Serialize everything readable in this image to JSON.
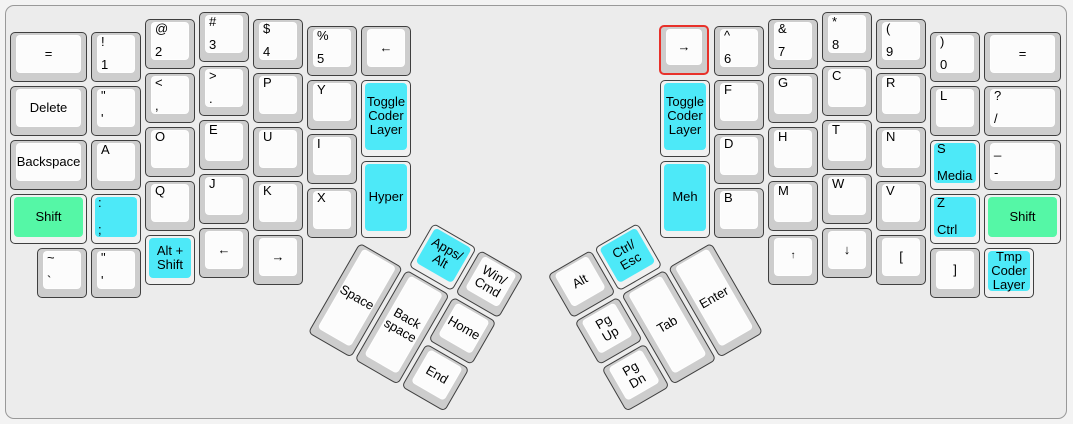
{
  "app": {
    "description": "ergodox-keyboard-layout"
  },
  "colors": {
    "page_background": "#f3f3f3",
    "board_background": "#ececec",
    "board_border": "#999999",
    "key_side": "#cdcdcd",
    "key_face": "#fcfcfc",
    "colored_key_side": "#f1f1f1",
    "cyan": "#4de9f8",
    "green": "#55f7a6",
    "selected_outline": "#e8312a",
    "legend": "#000000"
  },
  "layout": {
    "unit_px": 54,
    "key_inset_px": 2,
    "groups": [
      {
        "name": "left-main-cluster",
        "origin_x": 8,
        "origin_y": 10,
        "rotation_deg": 0,
        "keys": [
          {
            "name": "equal-left",
            "x": 0,
            "y": 0.375,
            "w": 1.5,
            "center": "="
          },
          {
            "name": "delete",
            "x": 0,
            "y": 1.375,
            "w": 1.5,
            "center": "Delete"
          },
          {
            "name": "backspace",
            "x": 0,
            "y": 2.375,
            "w": 1.5,
            "center": "Backspace"
          },
          {
            "name": "shift-left",
            "x": 0,
            "y": 3.375,
            "w": 1.5,
            "center": "Shift",
            "color": "green"
          },
          {
            "name": "exclamation-1",
            "x": 1.5,
            "y": 0.375,
            "top": "!",
            "bottom": "1"
          },
          {
            "name": "quote-apostrophe",
            "x": 1.5,
            "y": 1.375,
            "top": "\"",
            "bottom": "'"
          },
          {
            "name": "a",
            "x": 1.5,
            "y": 2.375,
            "top": "A"
          },
          {
            "name": "colon-semicolon",
            "x": 1.5,
            "y": 3.375,
            "top": ":",
            "bottom": ";",
            "color": "cyan"
          },
          {
            "name": "at-2",
            "x": 2.5,
            "y": 0.125,
            "top": "@",
            "bottom": "2"
          },
          {
            "name": "lessthan-comma",
            "x": 2.5,
            "y": 1.125,
            "top": "<",
            "bottom": ","
          },
          {
            "name": "o",
            "x": 2.5,
            "y": 2.125,
            "top": "O"
          },
          {
            "name": "q",
            "x": 2.5,
            "y": 3.125,
            "top": "Q"
          },
          {
            "name": "alt-shift",
            "x": 2.5,
            "y": 4.125,
            "center": "Alt +\nShift",
            "color": "cyan"
          },
          {
            "name": "hash-3",
            "x": 3.5,
            "y": 0,
            "top": "#",
            "bottom": "3"
          },
          {
            "name": "greaterthan-period",
            "x": 3.5,
            "y": 1,
            "top": ">",
            "bottom": "."
          },
          {
            "name": "e",
            "x": 3.5,
            "y": 2,
            "top": "E"
          },
          {
            "name": "j",
            "x": 3.5,
            "y": 3,
            "top": "J"
          },
          {
            "name": "left-arrow-bottom",
            "x": 3.5,
            "y": 4,
            "center": "←"
          },
          {
            "name": "dollar-4",
            "x": 4.5,
            "y": 0.125,
            "top": "$",
            "bottom": "4"
          },
          {
            "name": "p",
            "x": 4.5,
            "y": 1.125,
            "top": "P"
          },
          {
            "name": "u",
            "x": 4.5,
            "y": 2.125,
            "top": "U"
          },
          {
            "name": "k",
            "x": 4.5,
            "y": 3.125,
            "top": "K"
          },
          {
            "name": "right-arrow-bottom",
            "x": 4.5,
            "y": 4.125,
            "center": "→"
          },
          {
            "name": "percent-5",
            "x": 5.5,
            "y": 0.25,
            "top": "%",
            "bottom": "5"
          },
          {
            "name": "y",
            "x": 5.5,
            "y": 1.25,
            "top": "Y"
          },
          {
            "name": "i",
            "x": 5.5,
            "y": 2.25,
            "top": "I"
          },
          {
            "name": "x",
            "x": 5.5,
            "y": 3.25,
            "top": "X"
          },
          {
            "name": "left-arrow-inner",
            "x": 6.5,
            "y": 0.25,
            "center": "←"
          },
          {
            "name": "toggle-coder-layer-left",
            "x": 6.5,
            "y": 1.25,
            "h": 1.5,
            "center": "Toggle\nCoder\nLayer",
            "color": "cyan"
          },
          {
            "name": "hyper",
            "x": 6.5,
            "y": 2.75,
            "h": 1.5,
            "center": "Hyper",
            "color": "cyan"
          },
          {
            "name": "tilde-grave",
            "x": 0.5,
            "y": 4.375,
            "top": "~",
            "bottom": "`"
          },
          {
            "name": "quote-apostrophe-bottom",
            "x": 1.5,
            "y": 4.375,
            "top": "\"",
            "bottom": "'"
          }
        ]
      },
      {
        "name": "left-thumb-cluster",
        "origin_x": 359,
        "origin_y": 239.5,
        "rotation_deg": 30,
        "keys": [
          {
            "name": "apps-alt",
            "x": 1,
            "y": -1,
            "center": "Apps/\nAlt",
            "color": "cyan"
          },
          {
            "name": "win-cmd",
            "x": 2,
            "y": -1,
            "center": "Win/\nCmd"
          },
          {
            "name": "space",
            "x": 0,
            "y": 0,
            "h": 2,
            "center": "Space"
          },
          {
            "name": "backspace-thumb",
            "x": 1,
            "y": 0,
            "h": 2,
            "center": "Back\nspace"
          },
          {
            "name": "home",
            "x": 2,
            "y": 0,
            "center": "Home"
          },
          {
            "name": "end",
            "x": 2,
            "y": 1,
            "center": "End"
          }
        ]
      },
      {
        "name": "right-main-cluster",
        "origin_x": 658,
        "origin_y": 10,
        "rotation_deg": 0,
        "keys": [
          {
            "name": "right-arrow-inner",
            "x": 0,
            "y": 0.25,
            "center": "→",
            "selected": true
          },
          {
            "name": "toggle-coder-layer-right",
            "x": 0,
            "y": 1.25,
            "h": 1.5,
            "center": "Toggle\nCoder\nLayer",
            "color": "cyan"
          },
          {
            "name": "meh",
            "x": 0,
            "y": 2.75,
            "h": 1.5,
            "center": "Meh",
            "color": "cyan"
          },
          {
            "name": "caret-6",
            "x": 1,
            "y": 0.25,
            "top": "^",
            "bottom": "6"
          },
          {
            "name": "f",
            "x": 1,
            "y": 1.25,
            "top": "F"
          },
          {
            "name": "d",
            "x": 1,
            "y": 2.25,
            "top": "D"
          },
          {
            "name": "b",
            "x": 1,
            "y": 3.25,
            "top": "B"
          },
          {
            "name": "ampersand-7",
            "x": 2,
            "y": 0.125,
            "top": "&",
            "bottom": "7"
          },
          {
            "name": "g",
            "x": 2,
            "y": 1.125,
            "top": "G"
          },
          {
            "name": "h",
            "x": 2,
            "y": 2.125,
            "top": "H"
          },
          {
            "name": "m",
            "x": 2,
            "y": 3.125,
            "top": "M"
          },
          {
            "name": "up-arrow",
            "x": 2,
            "y": 4.125,
            "center": "↑",
            "size": 10
          },
          {
            "name": "asterisk-8",
            "x": 3,
            "y": 0,
            "top": "*",
            "bottom": "8"
          },
          {
            "name": "c",
            "x": 3,
            "y": 1,
            "top": "C"
          },
          {
            "name": "t",
            "x": 3,
            "y": 2,
            "top": "T"
          },
          {
            "name": "w",
            "x": 3,
            "y": 3,
            "top": "W"
          },
          {
            "name": "down-arrow",
            "x": 3,
            "y": 4,
            "center": "↓"
          },
          {
            "name": "paren-9",
            "x": 4,
            "y": 0.125,
            "top": "(",
            "bottom": "9"
          },
          {
            "name": "r",
            "x": 4,
            "y": 1.125,
            "top": "R"
          },
          {
            "name": "n",
            "x": 4,
            "y": 2.125,
            "top": "N"
          },
          {
            "name": "v",
            "x": 4,
            "y": 3.125,
            "top": "V"
          },
          {
            "name": "left-bracket",
            "x": 4,
            "y": 4.125,
            "center": "["
          },
          {
            "name": "paren-0",
            "x": 5,
            "y": 0.375,
            "top": ")",
            "bottom": "0"
          },
          {
            "name": "l",
            "x": 5,
            "y": 1.375,
            "top": "L"
          },
          {
            "name": "s-media",
            "x": 5,
            "y": 2.375,
            "top": "S",
            "bottom": "Media",
            "color": "cyan"
          },
          {
            "name": "z-ctrl",
            "x": 5,
            "y": 3.375,
            "top": "Z",
            "bottom": "Ctrl",
            "color": "cyan"
          },
          {
            "name": "right-bracket",
            "x": 5,
            "y": 4.375,
            "center": "]"
          },
          {
            "name": "equal-right",
            "x": 6,
            "y": 0.375,
            "w": 1.5,
            "center": "="
          },
          {
            "name": "question-slash",
            "x": 6,
            "y": 1.375,
            "w": 1.5,
            "top": "?",
            "bottom": "/"
          },
          {
            "name": "underscore-dash",
            "x": 6,
            "y": 2.375,
            "w": 1.5,
            "top": "_",
            "bottom": "-"
          },
          {
            "name": "shift-right",
            "x": 6,
            "y": 3.375,
            "w": 1.5,
            "center": "Shift",
            "color": "green"
          },
          {
            "name": "tmp-coder-layer",
            "x": 6,
            "y": 4.375,
            "center": "Tmp\nCoder\nLayer",
            "color": "cyan"
          }
        ]
      },
      {
        "name": "right-thumb-cluster",
        "origin_x": 712,
        "origin_y": 239.5,
        "rotation_deg": -30,
        "keys": [
          {
            "name": "alt",
            "x": -3,
            "y": -1,
            "center": "Alt"
          },
          {
            "name": "ctrl-esc",
            "x": -2,
            "y": -1,
            "center": "Ctrl/\nEsc",
            "color": "cyan"
          },
          {
            "name": "pg-up",
            "x": -3,
            "y": 0,
            "center": "Pg Up"
          },
          {
            "name": "tab",
            "x": -2,
            "y": 0,
            "h": 2,
            "center": "Tab"
          },
          {
            "name": "enter",
            "x": -1,
            "y": 0,
            "h": 2,
            "center": "Enter"
          },
          {
            "name": "pg-dn",
            "x": -3,
            "y": 1,
            "center": "Pg Dn"
          }
        ]
      }
    ]
  }
}
